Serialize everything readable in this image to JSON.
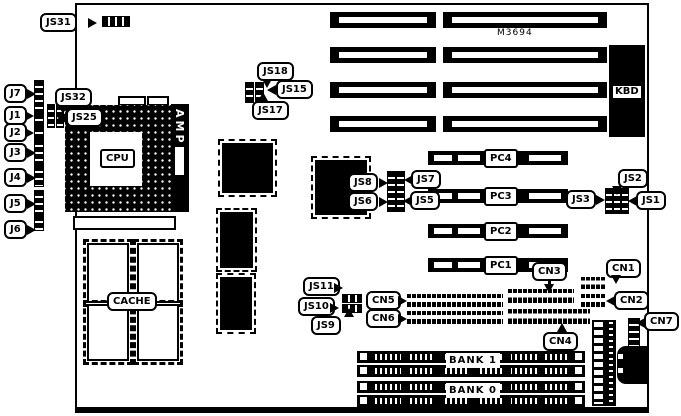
{
  "board": {
    "model": "M3694",
    "background": "#ffffff",
    "foreground": "#000000"
  },
  "labels": {
    "js31": "JS31",
    "js32": "JS32",
    "js25": "JS25",
    "js18": "JS18",
    "js15": "JS15",
    "js17": "JS17",
    "js8": "JS8",
    "js7": "JS7",
    "js6": "JS6",
    "js5": "JS5",
    "js3": "JS3",
    "js2": "JS2",
    "js1": "JS1",
    "js11": "JS11",
    "js10": "JS10",
    "js9": "JS9",
    "j7": "J7",
    "j1": "J1",
    "j2": "J2",
    "j3": "J3",
    "j4": "J4",
    "j5": "J5",
    "j6": "J6",
    "cpu": "CPU",
    "amp": "AMP",
    "cache": "CACHE",
    "kbd": "KBD",
    "model": "M3694",
    "pc4": "PC4",
    "pc3": "PC3",
    "pc2": "PC2",
    "pc1": "PC1",
    "cn1": "CN1",
    "cn2": "CN2",
    "cn3": "CN3",
    "cn4": "CN4",
    "cn5": "CN5",
    "cn6": "CN6",
    "cn7": "CN7",
    "bank1": "BANK 1",
    "bank0": "BANK 0"
  }
}
